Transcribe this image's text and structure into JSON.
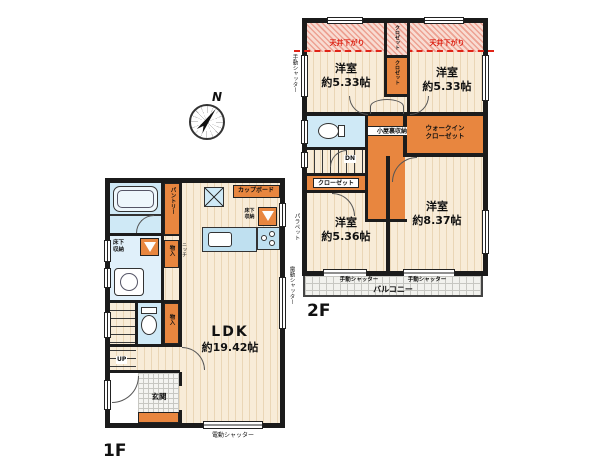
{
  "compass": {
    "north": "N"
  },
  "floor2": {
    "floor_label": "2F",
    "ceiling_notes": [
      "天井下がり",
      "天井下がり"
    ],
    "rooms": {
      "bedroom_top_left": {
        "name": "洋室",
        "size": "約5.33帖"
      },
      "bedroom_top_right": {
        "name": "洋室",
        "size": "約5.33帖"
      },
      "bedroom_bottom_left": {
        "name": "洋室",
        "size": "約5.36帖"
      },
      "bedroom_bottom_right": {
        "name": "洋室",
        "size": "約8.37帖"
      }
    },
    "closet_top": "クロゼット",
    "closet_mid": "クロゼット",
    "closet_left": "クローゼット",
    "attic_storage": "小屋裏収納",
    "walk_in_closet_line1": "ウォークイン",
    "walk_in_closet_line2": "クローゼット",
    "stairs_down": "DN",
    "balcony": "バルコニー",
    "shutter_left": "手動シャッター",
    "shutter_bottom_left": "手動シャッター",
    "shutter_bottom_right": "手動シャッター",
    "parapet": "パラペット"
  },
  "floor1": {
    "floor_label": "1F",
    "ldk": {
      "name": "LDK",
      "size": "約19.42帖"
    },
    "pantry": "パントリー",
    "cupboard": "カップボード",
    "underfloor_storage_kitchen": "床下収納",
    "underfloor_storage_washroom": "床下収納",
    "storage_hall": "物入",
    "niche": "ニッチ",
    "storage_toilet": "物入",
    "entrance": "玄関",
    "stairs_up": "UP",
    "shutter_right": "電動シャッター",
    "shutter_bottom": "電動シャッター"
  }
}
